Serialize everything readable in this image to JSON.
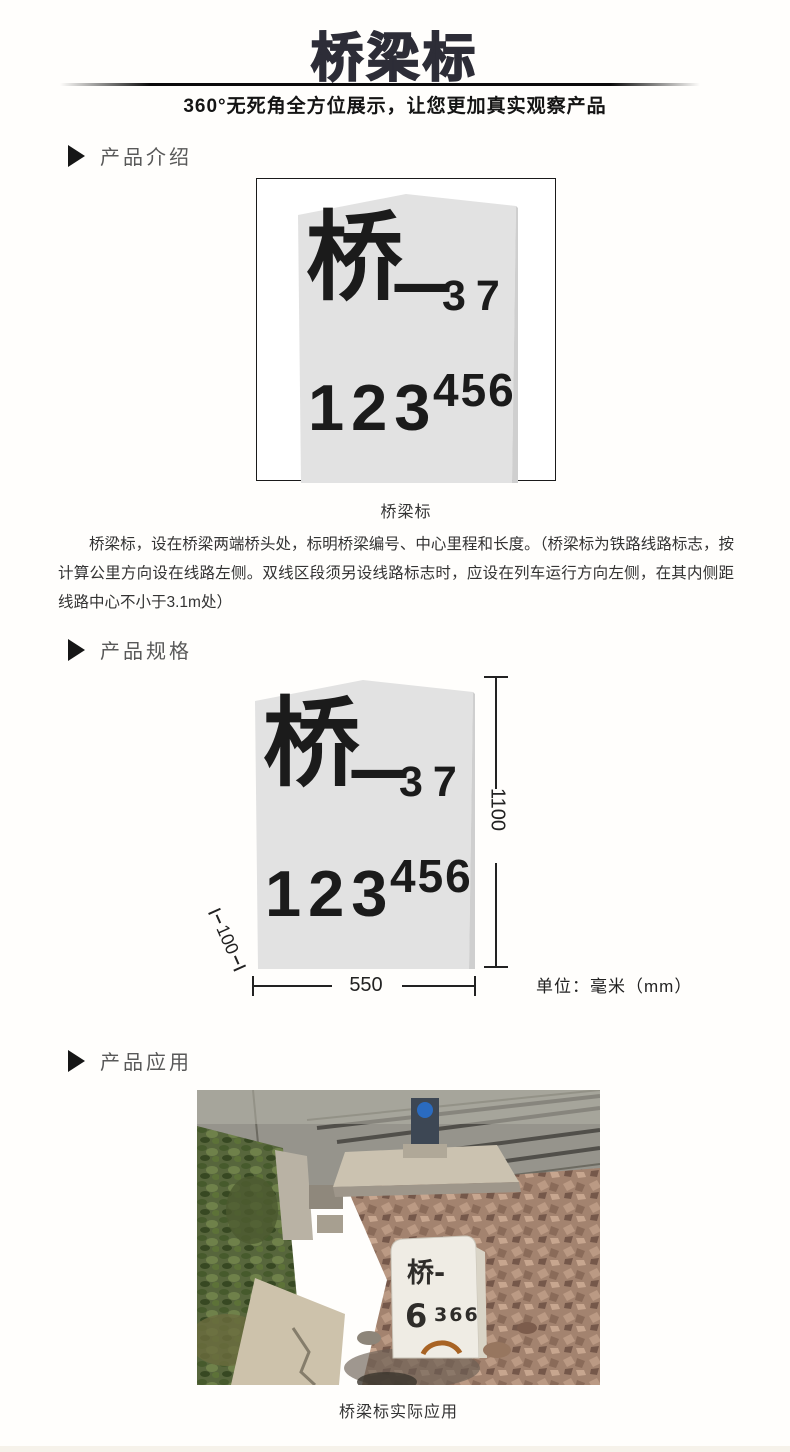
{
  "page": {
    "title": "桥梁标",
    "subtitle": "360°无死角全方位展示，让您更加真实观察产品"
  },
  "marker_face": {
    "char": "桥",
    "dash": "—",
    "serial": "37",
    "mileage_main": "123",
    "mileage_sup": "456"
  },
  "sections": {
    "intro": {
      "heading": "产品介绍",
      "figure_caption": "桥梁标",
      "description": "桥梁标，设在桥梁两端桥头处，标明桥梁编号、中心里程和长度。（桥梁标为铁路线路标志，按计算公里方向设在线路左侧。双线区段须另设线路标志时，应设在列车运行方向左侧，在其内侧距线路中心不小于3.1m处）"
    },
    "specs": {
      "heading": "产品规格",
      "height_mm": "1100",
      "width_mm": "550",
      "base_mm": "100",
      "unit_note": "单位：毫米（mm）"
    },
    "application": {
      "heading": "产品应用",
      "figure_caption": "桥梁标实际应用",
      "photo_stone_line1": "桥-",
      "photo_stone_num_big": "6",
      "photo_stone_num_small": "366"
    }
  },
  "colors": {
    "title_ink": "#2d2d37",
    "section_label": "#595959",
    "stone_fill": "#e2e2e2",
    "ink": "#1b1b1b"
  }
}
